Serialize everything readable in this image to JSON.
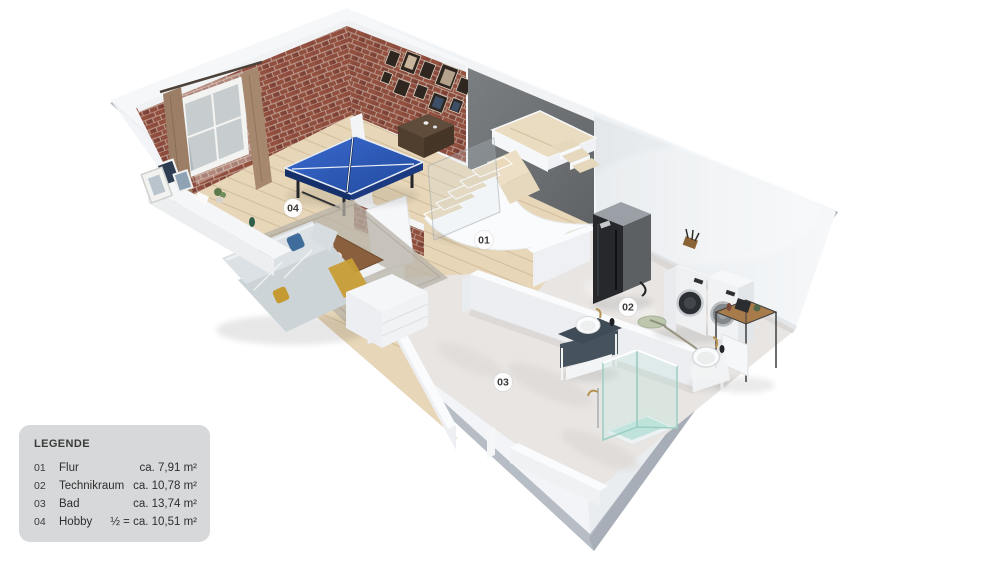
{
  "legend": {
    "title": "LEGENDE",
    "rows": [
      {
        "num": "01",
        "name": "Flur",
        "area": "ca. 7,91 m²"
      },
      {
        "num": "02",
        "name": "Technikraum",
        "area": "ca. 10,78 m²"
      },
      {
        "num": "03",
        "name": "Bad",
        "area": "ca. 13,74 m²"
      },
      {
        "num": "04",
        "name": "Hobby",
        "area": "½ = ca. 10,51 m²"
      }
    ]
  },
  "rooms": [
    {
      "label": "01",
      "name": "Flur"
    },
    {
      "label": "02",
      "name": "Technikraum"
    },
    {
      "label": "03",
      "name": "Bad"
    },
    {
      "label": "04",
      "name": "Hobby"
    }
  ],
  "colors": {
    "legend_bg": "#d7d8d9",
    "brick": "#8d4b3d",
    "wood_floor": "#e7d6b8",
    "stone_floor": "#e8e5e3",
    "accent_wall": "#6f7375",
    "exterior_wall": "#f5f7f9",
    "slab_edge": "#b7bdc5",
    "table_tennis_blue": "#2a5abf",
    "shower_glass": "#9ccdc2"
  }
}
